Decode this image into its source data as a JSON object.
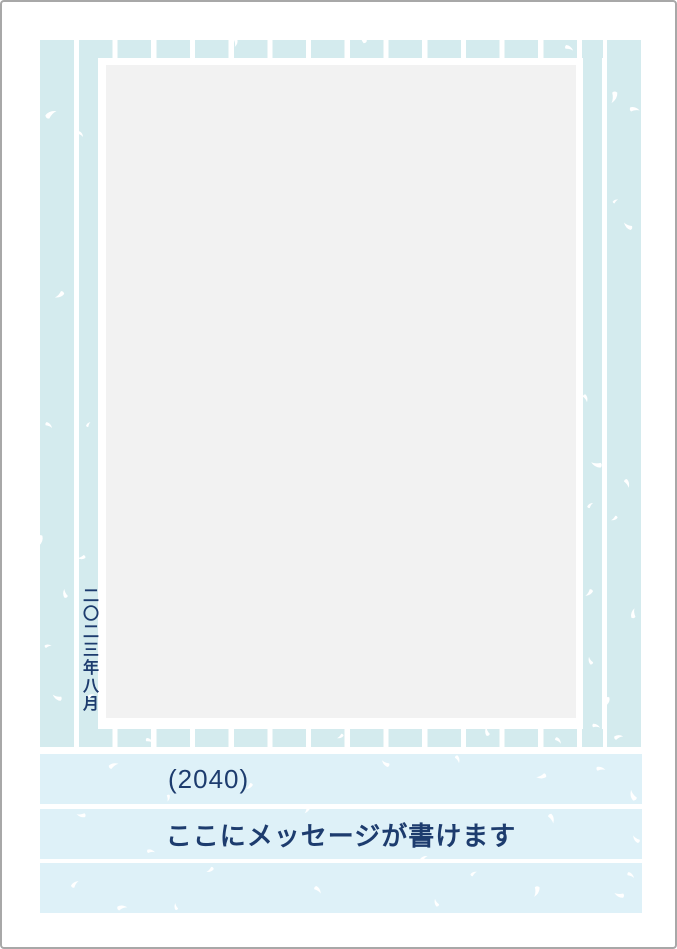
{
  "card": {
    "date_vertical": "二〇二三年八月",
    "design_number": "(2040)",
    "message_placeholder": "ここにメッセージが書けます"
  },
  "colors": {
    "stripe_blue": "#d4ebee",
    "band_blue": "#def1f8",
    "photo_gray": "#f2f2f2",
    "text_navy": "#1d3c6e",
    "page_border": "#a8a8a8"
  }
}
